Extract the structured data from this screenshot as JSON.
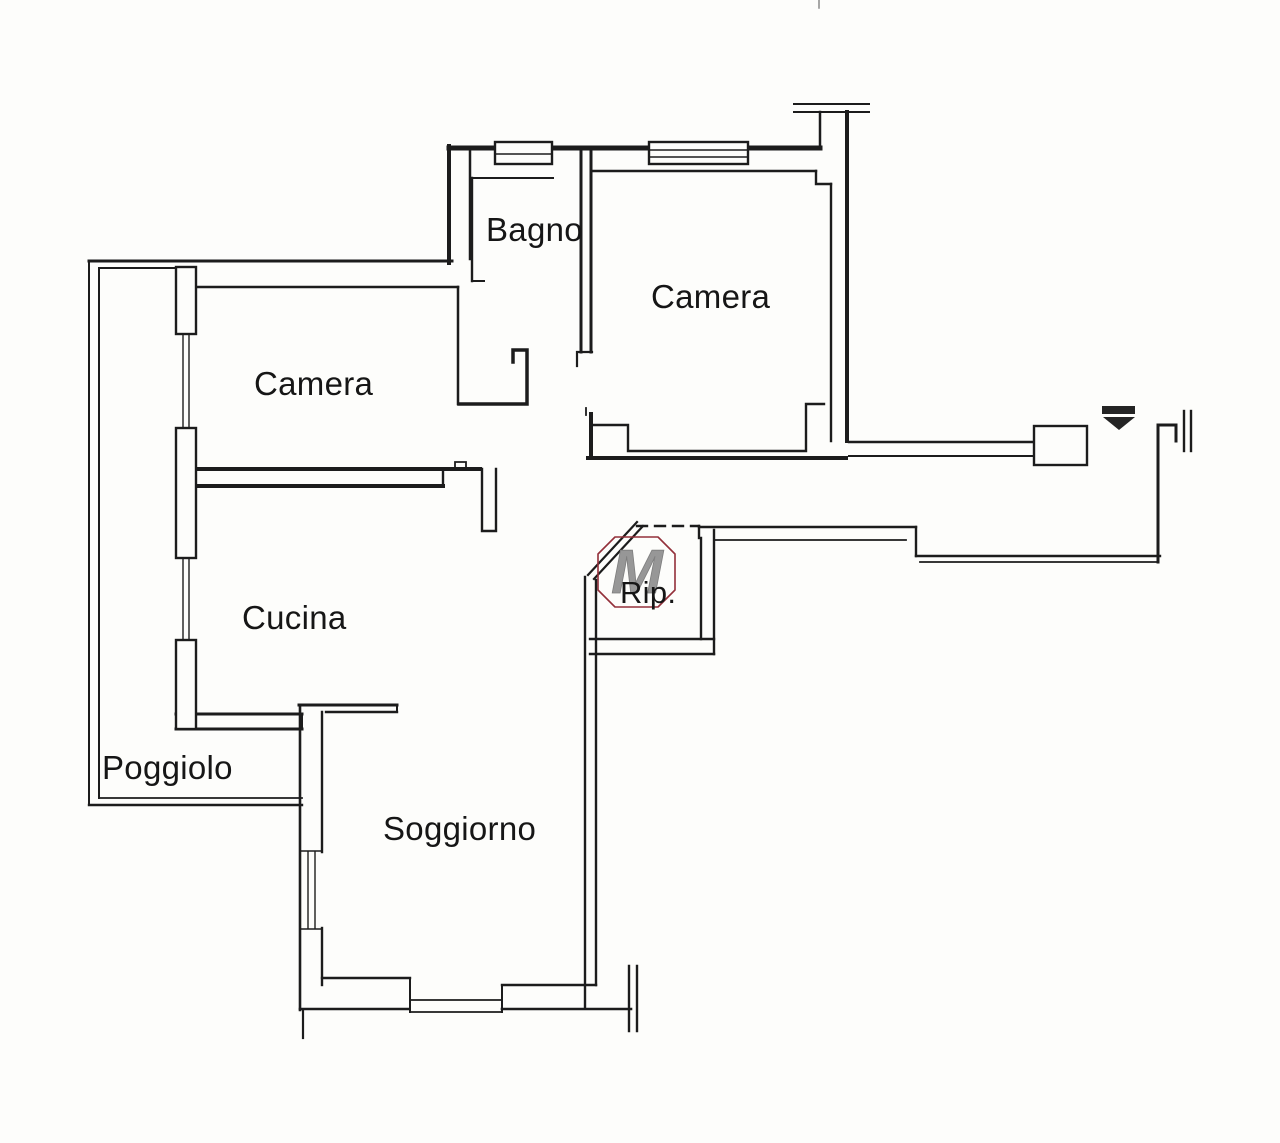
{
  "plan": {
    "background_color": "#fdfdfb",
    "line_color": "#1c1c1c",
    "rooms": [
      {
        "key": "bagno",
        "label": "Bagno"
      },
      {
        "key": "camera_nord",
        "label": "Camera"
      },
      {
        "key": "camera_ovest",
        "label": "Camera"
      },
      {
        "key": "cucina",
        "label": "Cucina"
      },
      {
        "key": "ripostiglio",
        "label": "Rip."
      },
      {
        "key": "poggiolo",
        "label": "Poggiolo"
      },
      {
        "key": "soggiorno",
        "label": "Soggiorno"
      }
    ],
    "watermark": {
      "letter": "M",
      "outline_color": "#93303a",
      "letter_color": "#979797"
    }
  }
}
